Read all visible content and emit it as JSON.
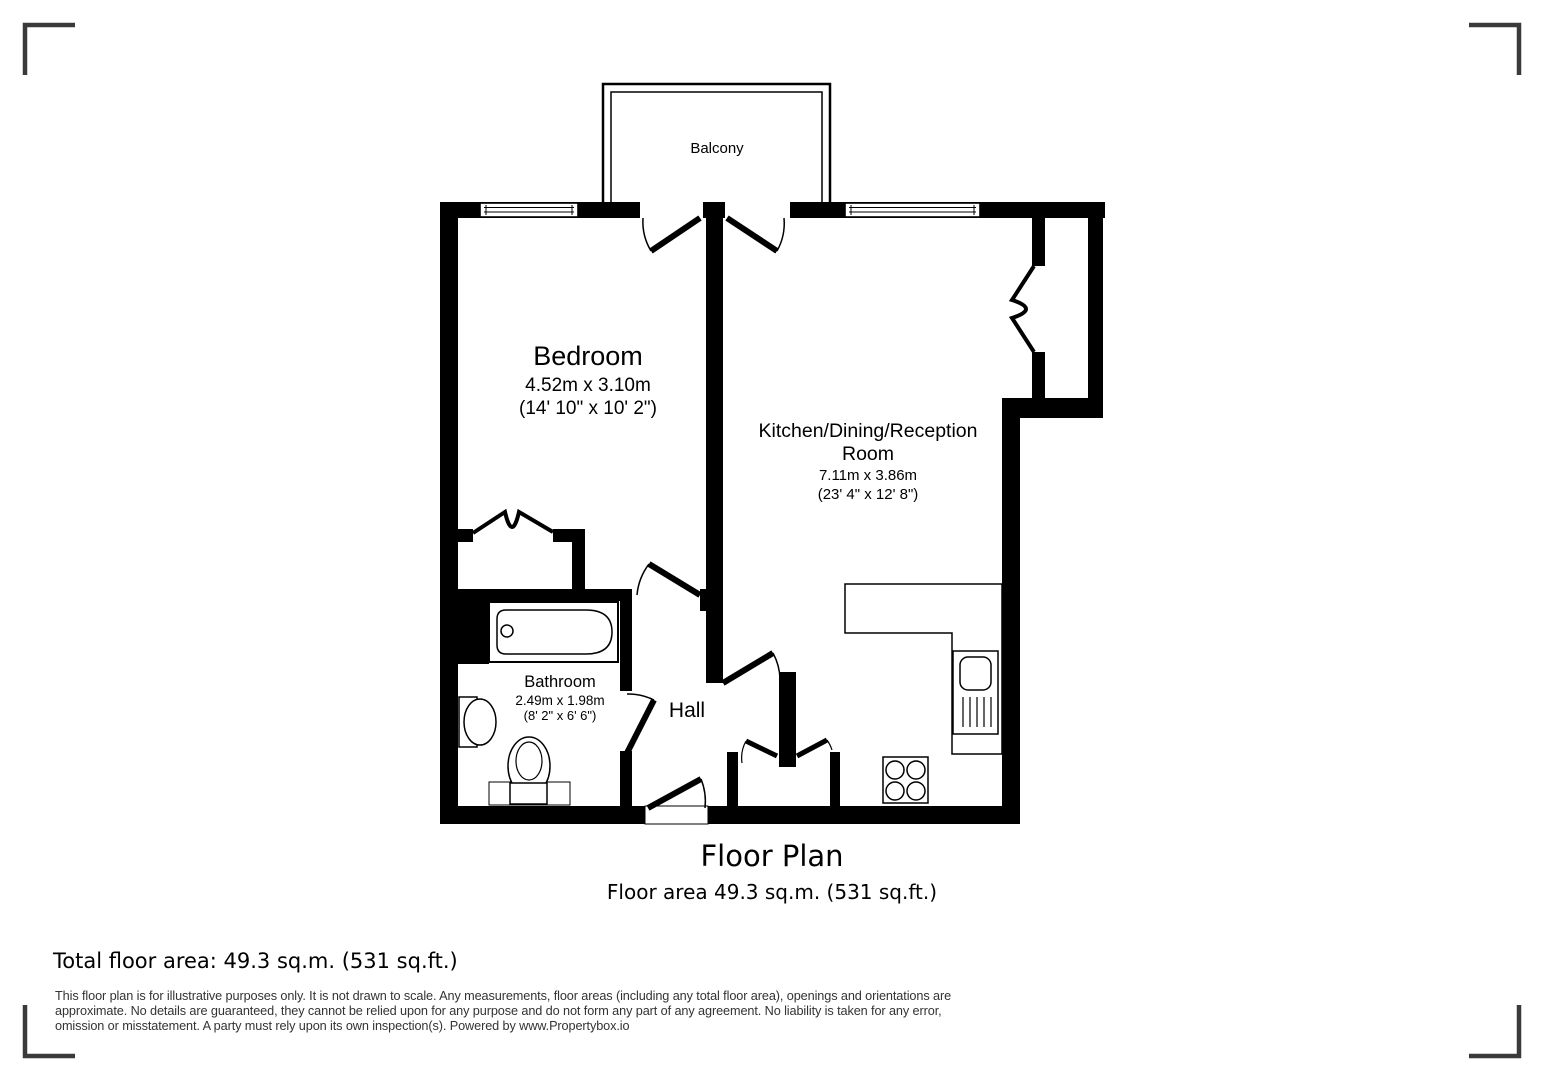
{
  "plan": {
    "balcony_label": "Balcony",
    "bedroom": {
      "name": "Bedroom",
      "metric": "4.52m x 3.10m",
      "imperial": "(14' 10\" x 10' 2\")"
    },
    "kitchen": {
      "name_line1": "Kitchen/Dining/Reception",
      "name_line2": "Room",
      "metric": "7.11m x 3.86m",
      "imperial": "(23' 4\" x 12' 8\")"
    },
    "bathroom": {
      "name": "Bathroom",
      "metric": "2.49m x 1.98m",
      "imperial": "(8' 2\" x 6' 6\")"
    },
    "hall_label": "Hall"
  },
  "caption": {
    "title": "Floor Plan",
    "area_line": "Floor area 49.3 sq.m. (531 sq.ft.)"
  },
  "footer": {
    "total_area": "Total floor area: 49.3 sq.m. (531 sq.ft.)",
    "disclaimer": [
      "This floor plan is for illustrative purposes only. It is not drawn to scale. Any measurements, floor areas (including any total floor area), openings and orientations are",
      "approximate. No details are guaranteed, they cannot be relied upon for any purpose and do not form any part of any agreement. No liability is taken for any error,",
      "omission or misstatement. A party must rely upon its own inspection(s). Powered by www.Propertybox.io"
    ]
  },
  "colors": {
    "wall": "#000000",
    "disclaimer_text": "#333333",
    "corner_mark": "#3a3a3a"
  }
}
